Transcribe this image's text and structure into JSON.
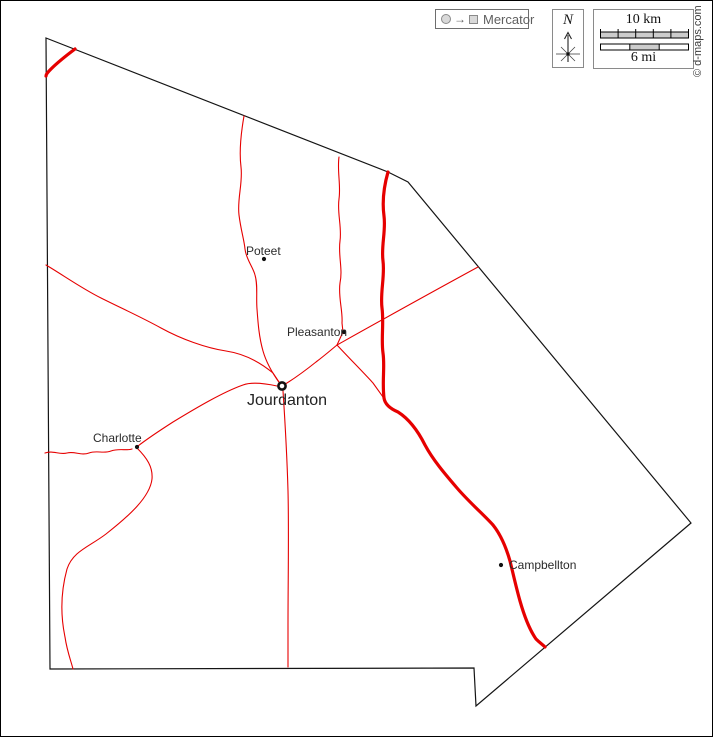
{
  "map": {
    "type": "county-outline-map",
    "cities": [
      {
        "name": "Poteet",
        "marker": "dot"
      },
      {
        "name": "Pleasanton",
        "marker": "dot"
      },
      {
        "name": "Jourdanton",
        "marker": "double-circle-county-seat"
      },
      {
        "name": "Charlotte",
        "marker": "dot"
      },
      {
        "name": "Campbellton",
        "marker": "dot"
      }
    ]
  },
  "controls": {
    "projection": {
      "label": "Mercator",
      "arrow": "→",
      "icons": [
        "circle-icon",
        "square-icon"
      ]
    },
    "compass": {
      "north": "N",
      "icon": "compass-rose-icon"
    },
    "scale": {
      "km": "10 km",
      "mi": "6 mi",
      "km_segments": 5,
      "mi_segments": 3
    }
  },
  "copyright": "© d-maps.com",
  "colors": {
    "road": "#e60000",
    "boundary": "#141414",
    "control_gray": "#5f5f5f",
    "scale_fill": "#cccccc"
  }
}
